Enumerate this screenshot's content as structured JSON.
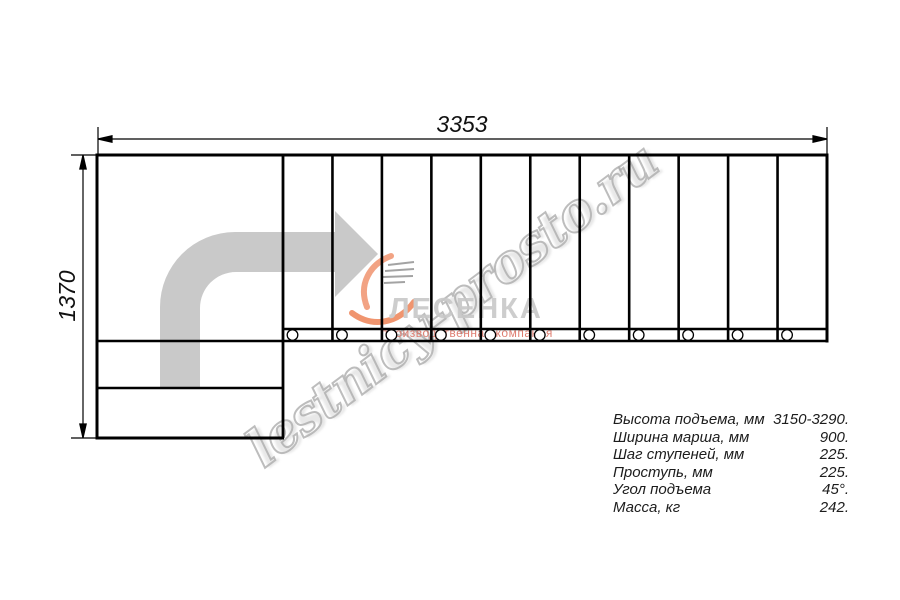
{
  "dimensions": {
    "width_label": "3353",
    "height_label": "1370"
  },
  "drawing": {
    "straight_steps": 11,
    "mount_circles": 11,
    "arrow_color": "#c9c9c9",
    "line_color": "#000000"
  },
  "watermark": {
    "text": "lestnicy-prosto.ru",
    "color": "#acacac"
  },
  "logo": {
    "brand": "ЛЕСЕНКА",
    "tagline": "производственная компания",
    "brand_color": "#c8c8c8",
    "tagline_color": "#dc7163",
    "flame_color": "#ef8a60"
  },
  "specs": {
    "rows": [
      {
        "label": "Высота подъема, мм",
        "value": "3150-3290."
      },
      {
        "label": "Ширина марша, мм",
        "value": "900."
      },
      {
        "label": "Шаг ступеней, мм",
        "value": "225."
      },
      {
        "label": "Проступь, мм",
        "value": "225."
      },
      {
        "label": "Угол подъема",
        "value": "45°."
      },
      {
        "label": "Масса, кг",
        "value": "242."
      }
    ]
  }
}
